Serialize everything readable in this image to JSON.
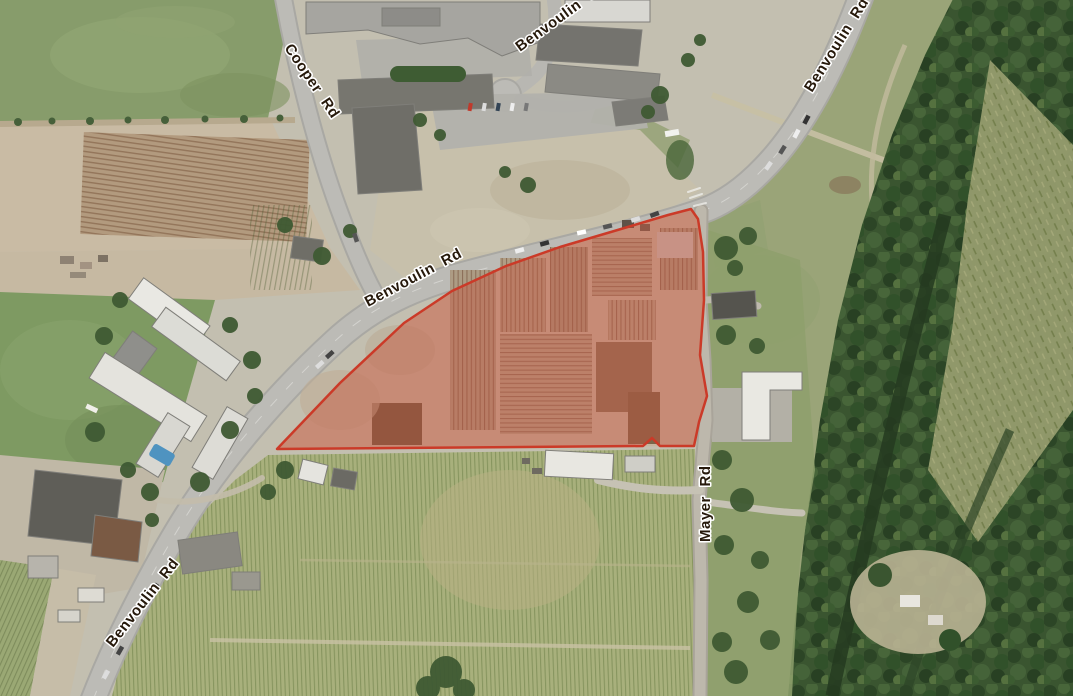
{
  "map": {
    "type": "aerial-satellite-view",
    "description": "Aerial photo with a highlighted land parcel at Benvoulin Rd and Mayer Rd",
    "road_labels": [
      {
        "id": "cooper-rd",
        "text": "Cooper Rd"
      },
      {
        "id": "benvoulin-crt",
        "text": "Benvoulin C"
      },
      {
        "id": "benvoulin-rd-ne",
        "text": "Benvoulin Rd"
      },
      {
        "id": "benvoulin-rd-mid",
        "text": "Benvoulin Rd"
      },
      {
        "id": "benvoulin-rd-sw",
        "text": "Benvoulin Rd"
      },
      {
        "id": "mayer-rd",
        "text": "Mayer Rd"
      }
    ],
    "highlight_parcel": {
      "fill": "#c8503c",
      "fill_opacity": "0.42",
      "stroke": "#cb3a28"
    }
  }
}
